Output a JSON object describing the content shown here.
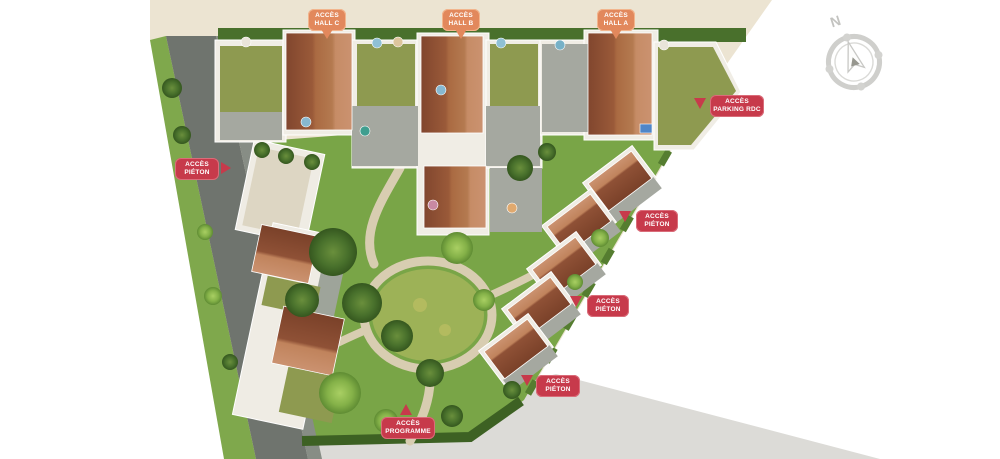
{
  "map": {
    "access_labels": {
      "hall_c": {
        "line1": "ACCÈS",
        "line2": "HALL C"
      },
      "hall_b": {
        "line1": "ACCÈS",
        "line2": "HALL B"
      },
      "hall_a": {
        "line1": "ACCÈS",
        "line2": "HALL A"
      },
      "parking_rdc": {
        "line1": "ACCÈS",
        "line2": "PARKING RDC"
      },
      "pieton_west": {
        "line1": "ACCÈS",
        "line2": "PIÉTON"
      },
      "pieton_northeast": {
        "line1": "ACCÈS",
        "line2": "PIÉTON"
      },
      "pieton_east": {
        "line1": "ACCÈS",
        "line2": "PIÉTON"
      },
      "pieton_southeast": {
        "line1": "ACCÈS",
        "line2": "PIÉTON"
      },
      "programme": {
        "line1": "ACCÈS",
        "line2": "PROGRAMME"
      }
    },
    "compass": {
      "north": "N"
    },
    "colors": {
      "hall_label_bg": "#e2885c",
      "hall_label_border": "#f2b58d",
      "access_label_bg": "#c73a4b",
      "access_label_border": "#da6d7a",
      "label_text": "#ffffff",
      "roof_dark": "#7f4630",
      "roof_mid": "#a8663f",
      "roof_light": "#cb9270",
      "green_roof": "#8e9a50",
      "lawn": "#79a547",
      "road": "#6f746e",
      "paving": "#ece4d2",
      "sidewalk": "#dcdbd7"
    }
  }
}
